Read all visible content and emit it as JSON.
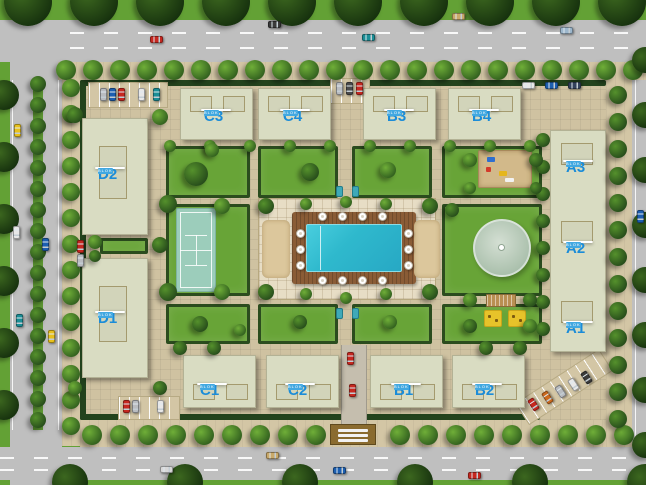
{
  "scene": {
    "w": 646,
    "h": 485,
    "name": "residential-complex-site-plan",
    "bg": "#63a135"
  },
  "colors": {
    "road": "#bfbfbf",
    "road_line": "#ffffff",
    "sidewalk": "#d3c6a5",
    "compound_path": "#cfc2a1",
    "plaza_tile": "#e7ddc5",
    "lawn": "#68a437",
    "hedge": "#23431d",
    "building": "#d9dcc2",
    "pool_water": "#2fb9cd",
    "pool_deck": "#8a5c36",
    "sand": "#dcc79c",
    "tennis_court": "#9ccdbb",
    "pond": "#a9bfab",
    "label_text_blue": "#1b8cd8",
    "label_sub_bg": "#41a8e1",
    "bench_teal": "#3fa9b8",
    "playground_sand": "#d2b98a",
    "mat_yellow": "#e7c32a"
  },
  "unit_labels": [
    {
      "text": "D2",
      "cx": 110,
      "cy": 168
    },
    {
      "text": "D1",
      "cx": 110,
      "cy": 312
    },
    {
      "text": "C3",
      "cx": 216,
      "cy": 110
    },
    {
      "text": "C4",
      "cx": 295,
      "cy": 110
    },
    {
      "text": "B3",
      "cx": 399,
      "cy": 110
    },
    {
      "text": "B4",
      "cx": 484,
      "cy": 110
    },
    {
      "text": "A3",
      "cx": 578,
      "cy": 161
    },
    {
      "text": "A2",
      "cx": 578,
      "cy": 242
    },
    {
      "text": "A1",
      "cx": 578,
      "cy": 322
    },
    {
      "text": "C1",
      "cx": 212,
      "cy": 384
    },
    {
      "text": "C2",
      "cx": 300,
      "cy": 384
    },
    {
      "text": "B1",
      "cx": 406,
      "cy": 384
    },
    {
      "text": "B2",
      "cx": 487,
      "cy": 384
    }
  ],
  "sub_label": "BLOK",
  "roads": {
    "rects": [
      {
        "x": 0,
        "y": 20,
        "w": 646,
        "h": 42
      },
      {
        "x": 0,
        "y": 447,
        "w": 646,
        "h": 33
      },
      {
        "x": 10,
        "y": 20,
        "w": 52,
        "h": 465
      },
      {
        "x": 632,
        "y": 20,
        "w": 14,
        "h": 465
      }
    ],
    "median": {
      "x": 33,
      "y": 78,
      "w": 10,
      "h": 352
    },
    "dashes": [
      {
        "x": 70,
        "y": 32,
        "w": 576
      },
      {
        "x": 70,
        "y": 47,
        "w": 576
      },
      {
        "x": 0,
        "y": 457,
        "w": 646
      },
      {
        "x": 0,
        "y": 469,
        "w": 646
      }
    ],
    "solid_lines": [
      {
        "x": 12,
        "y": 80,
        "w": 1,
        "h": 350
      },
      {
        "x": 58,
        "y": 80,
        "w": 1,
        "h": 350
      },
      {
        "x": 635,
        "y": 60,
        "w": 1,
        "h": 390
      }
    ]
  },
  "sidewalks": [
    {
      "x": 58,
      "y": 62,
      "w": 588,
      "h": 18
    },
    {
      "x": 62,
      "y": 78,
      "w": 18,
      "h": 368
    },
    {
      "x": 80,
      "y": 420,
      "w": 552,
      "h": 27
    },
    {
      "x": 606,
      "y": 62,
      "w": 26,
      "h": 385
    }
  ],
  "compound": {
    "x": 80,
    "y": 80,
    "w": 526,
    "h": 340
  },
  "hedges": [
    {
      "x": 80,
      "y": 80,
      "w": 526,
      "h": 6
    },
    {
      "x": 80,
      "y": 80,
      "w": 6,
      "h": 340
    },
    {
      "x": 80,
      "y": 414,
      "w": 460,
      "h": 6
    }
  ],
  "lawns": [
    {
      "x": 166,
      "y": 146,
      "w": 84,
      "h": 52
    },
    {
      "x": 258,
      "y": 146,
      "w": 80,
      "h": 52
    },
    {
      "x": 352,
      "y": 146,
      "w": 80,
      "h": 52
    },
    {
      "x": 442,
      "y": 146,
      "w": 100,
      "h": 52
    },
    {
      "x": 166,
      "y": 204,
      "w": 84,
      "h": 92
    },
    {
      "x": 442,
      "y": 204,
      "w": 100,
      "h": 92
    },
    {
      "x": 166,
      "y": 304,
      "w": 84,
      "h": 40
    },
    {
      "x": 258,
      "y": 304,
      "w": 80,
      "h": 40
    },
    {
      "x": 352,
      "y": 304,
      "w": 80,
      "h": 40
    },
    {
      "x": 442,
      "y": 304,
      "w": 100,
      "h": 40
    },
    {
      "x": 100,
      "y": 238,
      "w": 48,
      "h": 16
    }
  ],
  "blocks": [
    {
      "x": 82,
      "y": 118,
      "w": 66,
      "h": 117,
      "inner": [
        {
          "x": 16,
          "y": 27,
          "w": 28,
          "h": 53
        }
      ]
    },
    {
      "x": 82,
      "y": 258,
      "w": 66,
      "h": 120,
      "inner": [
        {
          "x": 16,
          "y": 27,
          "w": 28,
          "h": 56
        }
      ]
    },
    {
      "x": 180,
      "y": 88,
      "w": 73,
      "h": 52,
      "inner": [
        {
          "x": 9,
          "y": 7,
          "w": 22,
          "h": 16
        },
        {
          "x": 42,
          "y": 7,
          "w": 22,
          "h": 16
        }
      ]
    },
    {
      "x": 258,
      "y": 88,
      "w": 73,
      "h": 52,
      "inner": [
        {
          "x": 9,
          "y": 7,
          "w": 22,
          "h": 16
        },
        {
          "x": 42,
          "y": 7,
          "w": 22,
          "h": 16
        }
      ]
    },
    {
      "x": 363,
      "y": 88,
      "w": 73,
      "h": 52,
      "inner": [
        {
          "x": 9,
          "y": 7,
          "w": 22,
          "h": 16
        },
        {
          "x": 42,
          "y": 7,
          "w": 22,
          "h": 16
        }
      ]
    },
    {
      "x": 448,
      "y": 88,
      "w": 73,
      "h": 52,
      "inner": [
        {
          "x": 9,
          "y": 7,
          "w": 22,
          "h": 16
        },
        {
          "x": 42,
          "y": 7,
          "w": 22,
          "h": 16
        }
      ]
    },
    {
      "x": 550,
      "y": 130,
      "w": 56,
      "h": 222,
      "inner": [
        {
          "x": 10,
          "y": 12,
          "w": 32,
          "h": 22
        },
        {
          "x": 10,
          "y": 90,
          "w": 32,
          "h": 22
        },
        {
          "x": 10,
          "y": 170,
          "w": 32,
          "h": 22
        }
      ]
    },
    {
      "x": 183,
      "y": 355,
      "w": 73,
      "h": 53,
      "inner": [
        {
          "x": 9,
          "y": 28,
          "w": 22,
          "h": 16
        },
        {
          "x": 42,
          "y": 28,
          "w": 22,
          "h": 16
        }
      ]
    },
    {
      "x": 266,
      "y": 355,
      "w": 73,
      "h": 53,
      "inner": [
        {
          "x": 9,
          "y": 28,
          "w": 22,
          "h": 16
        },
        {
          "x": 42,
          "y": 28,
          "w": 22,
          "h": 16
        }
      ]
    },
    {
      "x": 370,
      "y": 355,
      "w": 73,
      "h": 53,
      "inner": [
        {
          "x": 9,
          "y": 28,
          "w": 22,
          "h": 16
        },
        {
          "x": 42,
          "y": 28,
          "w": 22,
          "h": 16
        }
      ]
    },
    {
      "x": 452,
      "y": 355,
      "w": 73,
      "h": 53,
      "inner": [
        {
          "x": 9,
          "y": 28,
          "w": 22,
          "h": 16
        },
        {
          "x": 42,
          "y": 28,
          "w": 22,
          "h": 16
        }
      ]
    }
  ],
  "amenities": {
    "plaza": {
      "x": 258,
      "y": 198,
      "w": 178,
      "h": 102
    },
    "deck": {
      "x": 292,
      "y": 212,
      "w": 124,
      "h": 72
    },
    "pool": {
      "x": 306,
      "y": 224,
      "w": 96,
      "h": 48
    },
    "sand": [
      {
        "x": 262,
        "y": 220,
        "w": 28,
        "h": 58
      },
      {
        "x": 414,
        "y": 220,
        "w": 26,
        "h": 58
      }
    ],
    "umbrellas": [
      [
        322,
        216
      ],
      [
        342,
        216
      ],
      [
        362,
        216
      ],
      [
        382,
        216
      ],
      [
        322,
        280
      ],
      [
        342,
        280
      ],
      [
        362,
        280
      ],
      [
        382,
        280
      ],
      [
        300,
        233
      ],
      [
        300,
        249
      ],
      [
        300,
        265
      ],
      [
        408,
        233
      ],
      [
        408,
        249
      ],
      [
        408,
        265
      ]
    ],
    "tennis": {
      "x": 176,
      "y": 208,
      "w": 40,
      "h": 84
    },
    "pond": {
      "cx": 502,
      "cy": 248,
      "r": 29
    },
    "playground": {
      "x": 478,
      "y": 150,
      "w": 54,
      "h": 38,
      "items": [
        {
          "x": 8,
          "y": 6,
          "w": 8,
          "h": 5,
          "c": "#2f6fd0"
        },
        {
          "x": 7,
          "y": 16,
          "w": 5,
          "h": 5,
          "c": "#d43a2a"
        },
        {
          "x": 20,
          "y": 20,
          "w": 8,
          "h": 5,
          "c": "#e5b61e"
        },
        {
          "x": 26,
          "y": 27,
          "w": 9,
          "h": 4,
          "c": "#f2f2f2"
        }
      ]
    },
    "mats": [
      {
        "x": 484,
        "y": 310,
        "w": 18,
        "h": 17
      },
      {
        "x": 508,
        "y": 310,
        "w": 18,
        "h": 17
      }
    ],
    "trellis": {
      "x": 486,
      "y": 294,
      "w": 30,
      "h": 13
    },
    "benches": [
      [
        336,
        186
      ],
      [
        352,
        186
      ],
      [
        336,
        308
      ],
      [
        352,
        308
      ]
    ],
    "drive": {
      "x": 341,
      "y": 345,
      "w": 26,
      "h": 100
    },
    "gate": {
      "x": 330,
      "y": 424,
      "w": 46,
      "h": 21
    }
  },
  "parking": [
    {
      "x": 88,
      "y": 82,
      "w": 80,
      "h": 26,
      "rot": 0
    },
    {
      "x": 330,
      "y": 78,
      "w": 40,
      "h": 26,
      "rot": 0
    },
    {
      "x": 118,
      "y": 396,
      "w": 62,
      "h": 24,
      "rot": 0
    },
    {
      "x": 514,
      "y": 374,
      "w": 100,
      "h": 26,
      "rot": -33
    }
  ],
  "cars": [
    {
      "x": 150,
      "y": 36,
      "o": "h",
      "c": "#c62820"
    },
    {
      "x": 268,
      "y": 21,
      "o": "h",
      "c": "#3a3a3a"
    },
    {
      "x": 362,
      "y": 34,
      "o": "h",
      "c": "#1b8e96"
    },
    {
      "x": 452,
      "y": 13,
      "o": "h",
      "c": "#c9a96a"
    },
    {
      "x": 560,
      "y": 27,
      "o": "h",
      "c": "#9db7cc"
    },
    {
      "x": 160,
      "y": 466,
      "o": "h",
      "c": "#d8d8d8"
    },
    {
      "x": 266,
      "y": 452,
      "o": "h",
      "c": "#c9a96a"
    },
    {
      "x": 333,
      "y": 467,
      "o": "h",
      "c": "#1d5fb0"
    },
    {
      "x": 468,
      "y": 472,
      "o": "h",
      "c": "#c62820"
    },
    {
      "x": 14,
      "y": 124,
      "o": "v",
      "c": "#e8c11c"
    },
    {
      "x": 13,
      "y": 226,
      "o": "v",
      "c": "#e8e8e8"
    },
    {
      "x": 42,
      "y": 238,
      "o": "v",
      "c": "#1d5fb0"
    },
    {
      "x": 16,
      "y": 314,
      "o": "v",
      "c": "#1b8e96"
    },
    {
      "x": 48,
      "y": 330,
      "o": "v",
      "c": "#e8c11c"
    },
    {
      "x": 637,
      "y": 210,
      "o": "v",
      "c": "#1d5fb0"
    },
    {
      "x": 100,
      "y": 88,
      "o": "v",
      "c": "#b9bcc0"
    },
    {
      "x": 109,
      "y": 88,
      "o": "v",
      "c": "#1d5fb0"
    },
    {
      "x": 118,
      "y": 88,
      "o": "v",
      "c": "#c62820"
    },
    {
      "x": 138,
      "y": 88,
      "o": "v",
      "c": "#e8e8e8"
    },
    {
      "x": 153,
      "y": 88,
      "o": "v",
      "c": "#1b8e96"
    },
    {
      "x": 336,
      "y": 82,
      "o": "v",
      "c": "#b9bcc0"
    },
    {
      "x": 346,
      "y": 82,
      "o": "v",
      "c": "#4a4a4a"
    },
    {
      "x": 356,
      "y": 82,
      "o": "v",
      "c": "#c62820"
    },
    {
      "x": 123,
      "y": 400,
      "o": "v",
      "c": "#c62820"
    },
    {
      "x": 132,
      "y": 400,
      "o": "v",
      "c": "#b9bcc0"
    },
    {
      "x": 157,
      "y": 400,
      "o": "v",
      "c": "#e8e8e8"
    },
    {
      "x": 522,
      "y": 82,
      "o": "h",
      "c": "#e8e8e8"
    },
    {
      "x": 545,
      "y": 82,
      "o": "h",
      "c": "#1d5fb0"
    },
    {
      "x": 568,
      "y": 82,
      "o": "h",
      "c": "#33415c"
    },
    {
      "x": 77,
      "y": 240,
      "o": "v",
      "c": "#c62820"
    },
    {
      "x": 77,
      "y": 254,
      "o": "v",
      "c": "#b9bcc0"
    },
    {
      "x": 347,
      "y": 352,
      "o": "v",
      "c": "#c62820"
    },
    {
      "x": 349,
      "y": 384,
      "o": "v",
      "c": "#c62820"
    },
    {
      "x": 530,
      "y": 398,
      "o": "v",
      "c": "#c62820",
      "rot": -33
    },
    {
      "x": 544,
      "y": 391,
      "o": "v",
      "c": "#cc6a1e",
      "rot": -33
    },
    {
      "x": 557,
      "y": 385,
      "o": "v",
      "c": "#b9bcc0",
      "rot": -33
    },
    {
      "x": 570,
      "y": 378,
      "o": "v",
      "c": "#e8e8e8",
      "rot": -33
    },
    {
      "x": 583,
      "y": 371,
      "o": "v",
      "c": "#3a3a3a",
      "rot": -33
    }
  ],
  "trees": {
    "palettes": [
      [
        "#6fae38",
        "#2e5b1d"
      ],
      [
        "#55912c",
        "#24481a"
      ],
      [
        "#83bd49",
        "#3a6b22"
      ],
      [
        "#3c671f",
        "#142e0d"
      ]
    ],
    "rows": [
      {
        "axis": "x",
        "fixed": 2,
        "from": 28,
        "to": 628,
        "step": 66,
        "r": 24,
        "p": 3
      },
      {
        "axis": "x",
        "fixed": 70,
        "from": 66,
        "to": 640,
        "step": 27,
        "r": 10,
        "p": 0
      },
      {
        "axis": "y",
        "fixed": 4,
        "from": 95,
        "to": 460,
        "step": 62,
        "r": 15,
        "p": 3
      },
      {
        "axis": "y",
        "fixed": 38,
        "from": 84,
        "to": 426,
        "step": 21,
        "r": 8,
        "p": 1
      },
      {
        "axis": "y",
        "fixed": 71,
        "from": 88,
        "to": 430,
        "step": 26,
        "r": 9,
        "p": 0
      },
      {
        "axis": "x",
        "fixed": 435,
        "from": 92,
        "to": 632,
        "step": 28,
        "r": 10,
        "p": 0,
        "skip": [
          318,
          382
        ]
      },
      {
        "axis": "x",
        "fixed": 482,
        "from": 70,
        "to": 646,
        "step": 115,
        "r": 18,
        "p": 3
      },
      {
        "axis": "y",
        "fixed": 618,
        "from": 95,
        "to": 435,
        "step": 27,
        "r": 9,
        "p": 1
      },
      {
        "axis": "y",
        "fixed": 645,
        "from": 60,
        "to": 470,
        "step": 55,
        "r": 13,
        "p": 3
      },
      {
        "axis": "y",
        "fixed": 543,
        "from": 140,
        "to": 330,
        "step": 27,
        "r": 7,
        "p": 1
      },
      {
        "axis": "x",
        "fixed": 348,
        "from": 180,
        "to": 530,
        "step": 34,
        "r": 7,
        "p": 1,
        "skip": [
          240,
          460
        ]
      },
      {
        "axis": "x",
        "fixed": 146,
        "from": 170,
        "to": 530,
        "step": 40,
        "r": 6,
        "p": 0
      }
    ],
    "singles": [
      [
        168,
        204,
        9,
        1
      ],
      [
        222,
        206,
        8,
        0
      ],
      [
        168,
        292,
        9,
        1
      ],
      [
        222,
        292,
        8,
        0
      ],
      [
        196,
        174,
        12,
        1
      ],
      [
        212,
        150,
        7,
        0
      ],
      [
        310,
        172,
        9,
        1
      ],
      [
        388,
        170,
        8,
        0
      ],
      [
        266,
        206,
        8,
        1
      ],
      [
        430,
        206,
        8,
        1
      ],
      [
        266,
        292,
        8,
        1
      ],
      [
        430,
        292,
        8,
        1
      ],
      [
        306,
        204,
        6,
        0
      ],
      [
        346,
        202,
        6,
        0
      ],
      [
        386,
        204,
        6,
        0
      ],
      [
        306,
        294,
        6,
        0
      ],
      [
        346,
        298,
        6,
        0
      ],
      [
        386,
        294,
        6,
        0
      ],
      [
        452,
        210,
        7,
        1
      ],
      [
        470,
        300,
        7,
        0
      ],
      [
        530,
        300,
        7,
        1
      ],
      [
        200,
        324,
        8,
        1
      ],
      [
        240,
        330,
        6,
        0
      ],
      [
        300,
        322,
        7,
        1
      ],
      [
        390,
        322,
        7,
        0
      ],
      [
        470,
        326,
        7,
        1
      ],
      [
        530,
        326,
        7,
        0
      ],
      [
        75,
        115,
        8,
        1
      ],
      [
        160,
        117,
        8,
        0
      ],
      [
        160,
        245,
        8,
        1
      ],
      [
        75,
        388,
        7,
        0
      ],
      [
        160,
        388,
        7,
        1
      ],
      [
        470,
        160,
        7,
        0
      ],
      [
        536,
        160,
        7,
        1
      ],
      [
        470,
        188,
        6,
        0
      ],
      [
        536,
        188,
        6,
        1
      ],
      [
        95,
        242,
        7,
        0
      ],
      [
        95,
        256,
        6,
        1
      ]
    ]
  }
}
